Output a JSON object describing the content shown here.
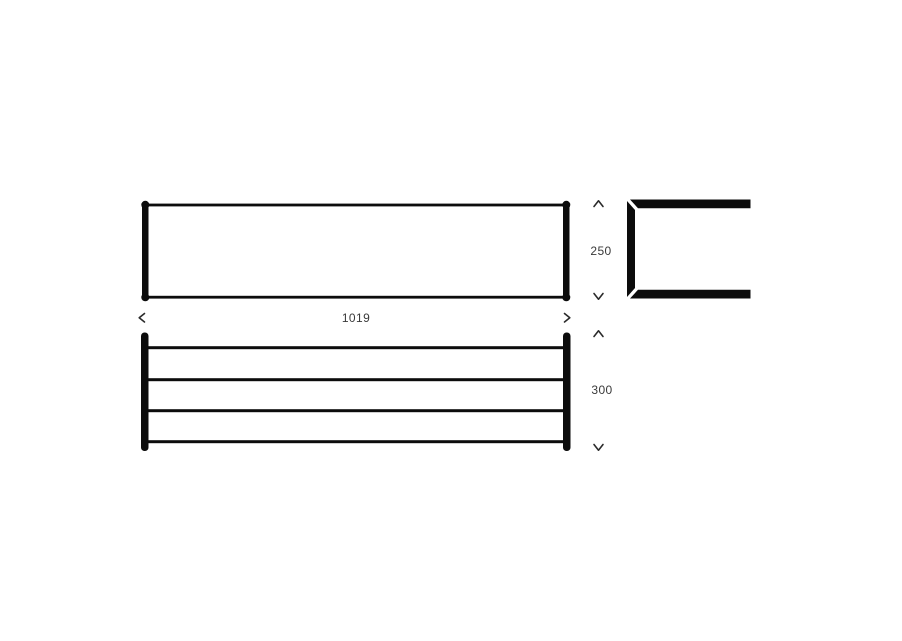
{
  "colors": {
    "background": "#ffffff",
    "line": "#0c0c0c",
    "dim_text": "#3a3a3a"
  },
  "dimensions": {
    "width": {
      "value": "1019",
      "orientation": "horizontal"
    },
    "height": {
      "value": "250",
      "orientation": "vertical"
    },
    "depth": {
      "value": "300",
      "orientation": "vertical"
    }
  },
  "structure": {
    "views": [
      "front-elevation",
      "side-profile",
      "plan-rack"
    ],
    "plan_rail_count": 4
  },
  "icons": {
    "arrow_left": "chevron-left",
    "arrow_right": "chevron-right",
    "arrow_up": "chevron-up",
    "arrow_down": "chevron-down"
  }
}
